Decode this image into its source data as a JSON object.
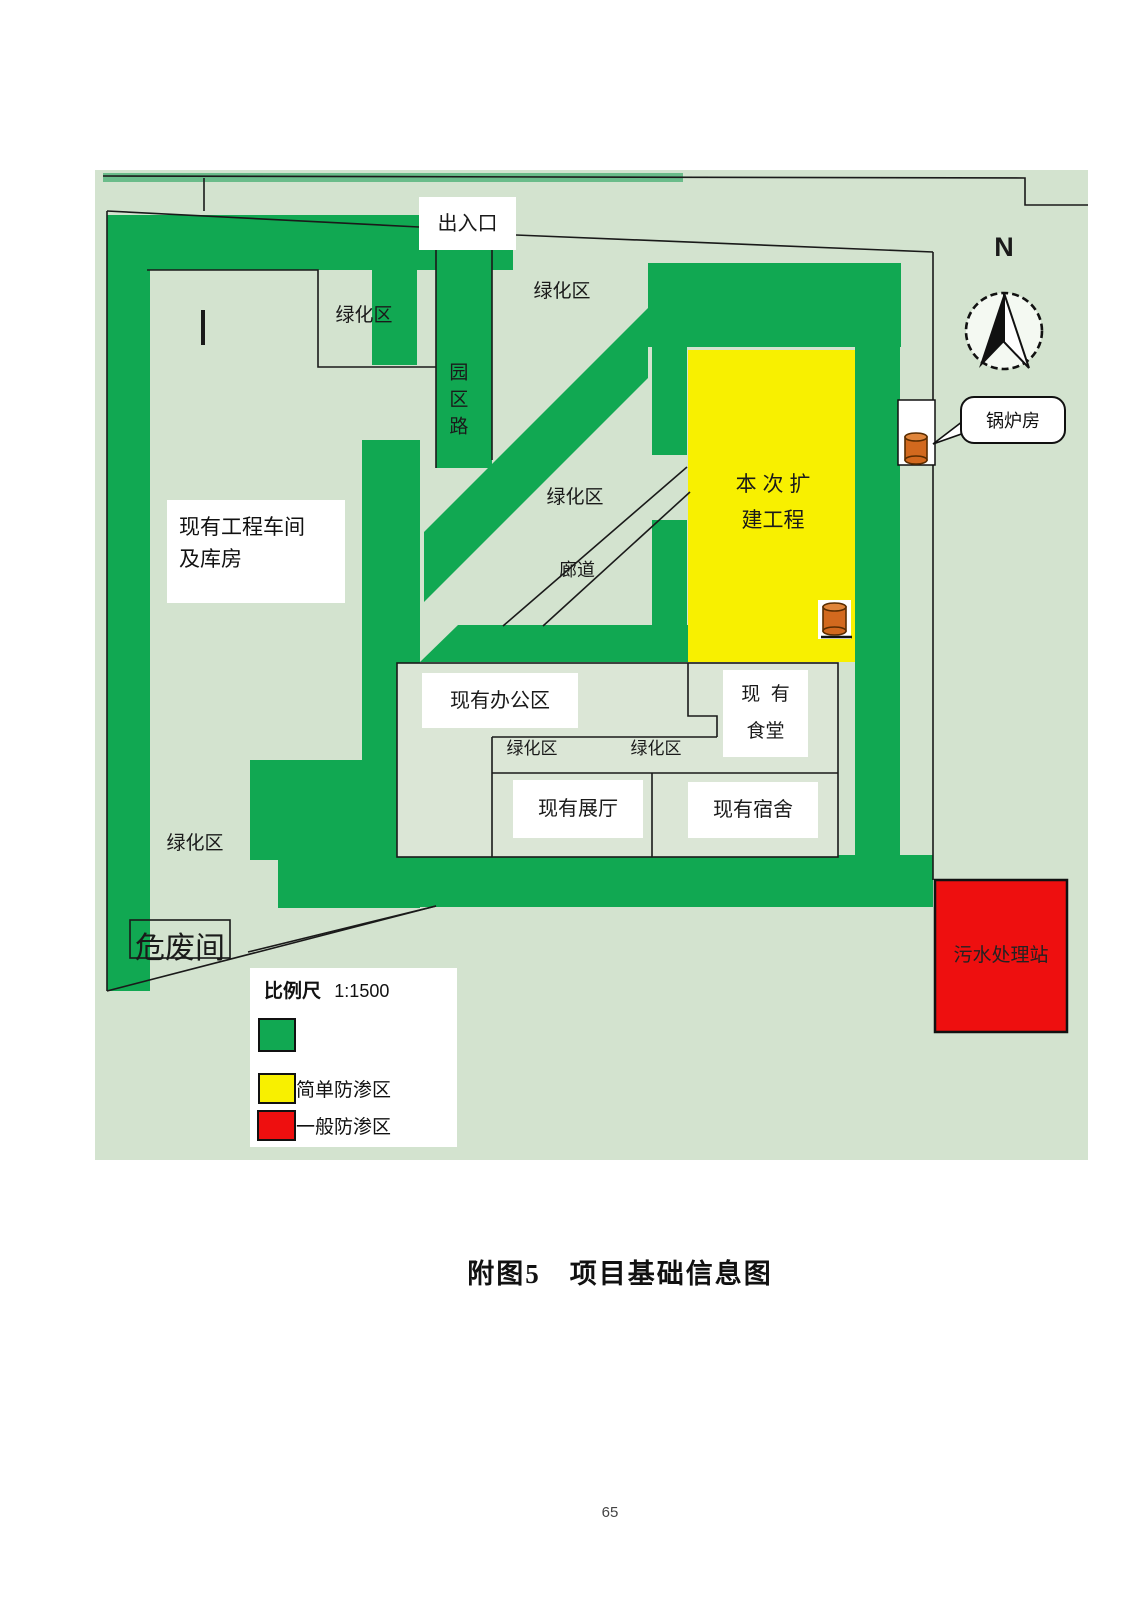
{
  "page": {
    "caption": "附图5　项目基础信息图",
    "page_number": "65"
  },
  "colors": {
    "map_background": "#d3e3cf",
    "green_zone": "#11a852",
    "yellow_zone": "#f8f000",
    "red_zone": "#ee0f0f",
    "orange_tank": "#d2691e"
  },
  "map": {
    "entrance": "出入口",
    "road_vertical": "园区路",
    "green_area": "绿化区",
    "workshop_line1": "现有工程车间",
    "workshop_line2": "及库房",
    "expansion_line1": "本 次 扩",
    "expansion_line2": "建工程",
    "corridor": "廊道",
    "boiler": "锅炉房",
    "office": "现有办公区",
    "canteen_line1": "现  有",
    "canteen_line2": "食堂",
    "exhibition": "现有展厅",
    "dormitory": "现有宿舍",
    "hazardous": "危废间",
    "sewage": "污水处理站",
    "compass_n": "N",
    "legend": {
      "scale_label": "比例尺",
      "scale_value": "1:1500",
      "green_label": "",
      "yellow_label": "简单防渗区",
      "red_label": "一般防渗区"
    }
  }
}
